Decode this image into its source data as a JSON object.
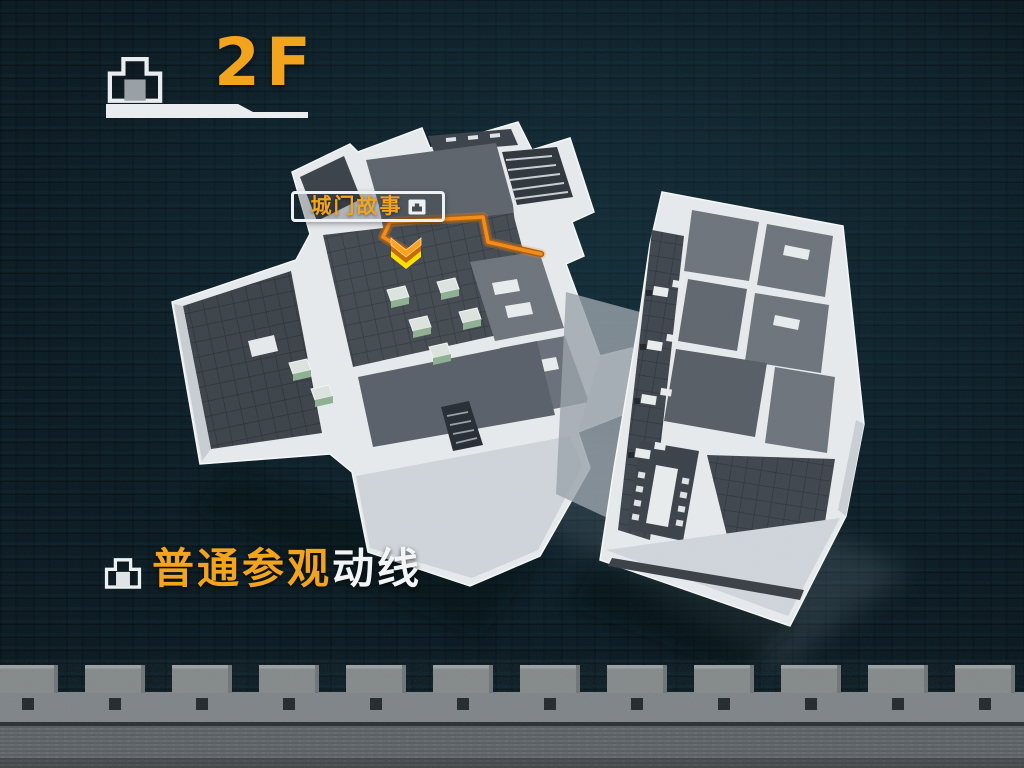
{
  "screen": {
    "type": "floor-guide-3d-map"
  },
  "header": {
    "floor_label": "2F",
    "icon": "gate-icon"
  },
  "map": {
    "route_callout": {
      "text": "城门故事",
      "icon": "gate-icon"
    },
    "marker": {
      "name": "current-position-chevron",
      "colors": [
        "#FFA01E",
        "#C76A00",
        "#FFDF00"
      ]
    },
    "route_color": "#EF8D1F"
  },
  "legend": {
    "icon": "gate-icon",
    "highlight_text": "普通参观",
    "normal_text": "动线"
  },
  "colors": {
    "accent_orange": "#F2A41F",
    "background_brick": "#0A1820",
    "building_wall": "#E7EAED",
    "floor_dark": "#454B52",
    "stone_wall": "#7E8387",
    "text_white": "#F2F4F6"
  }
}
